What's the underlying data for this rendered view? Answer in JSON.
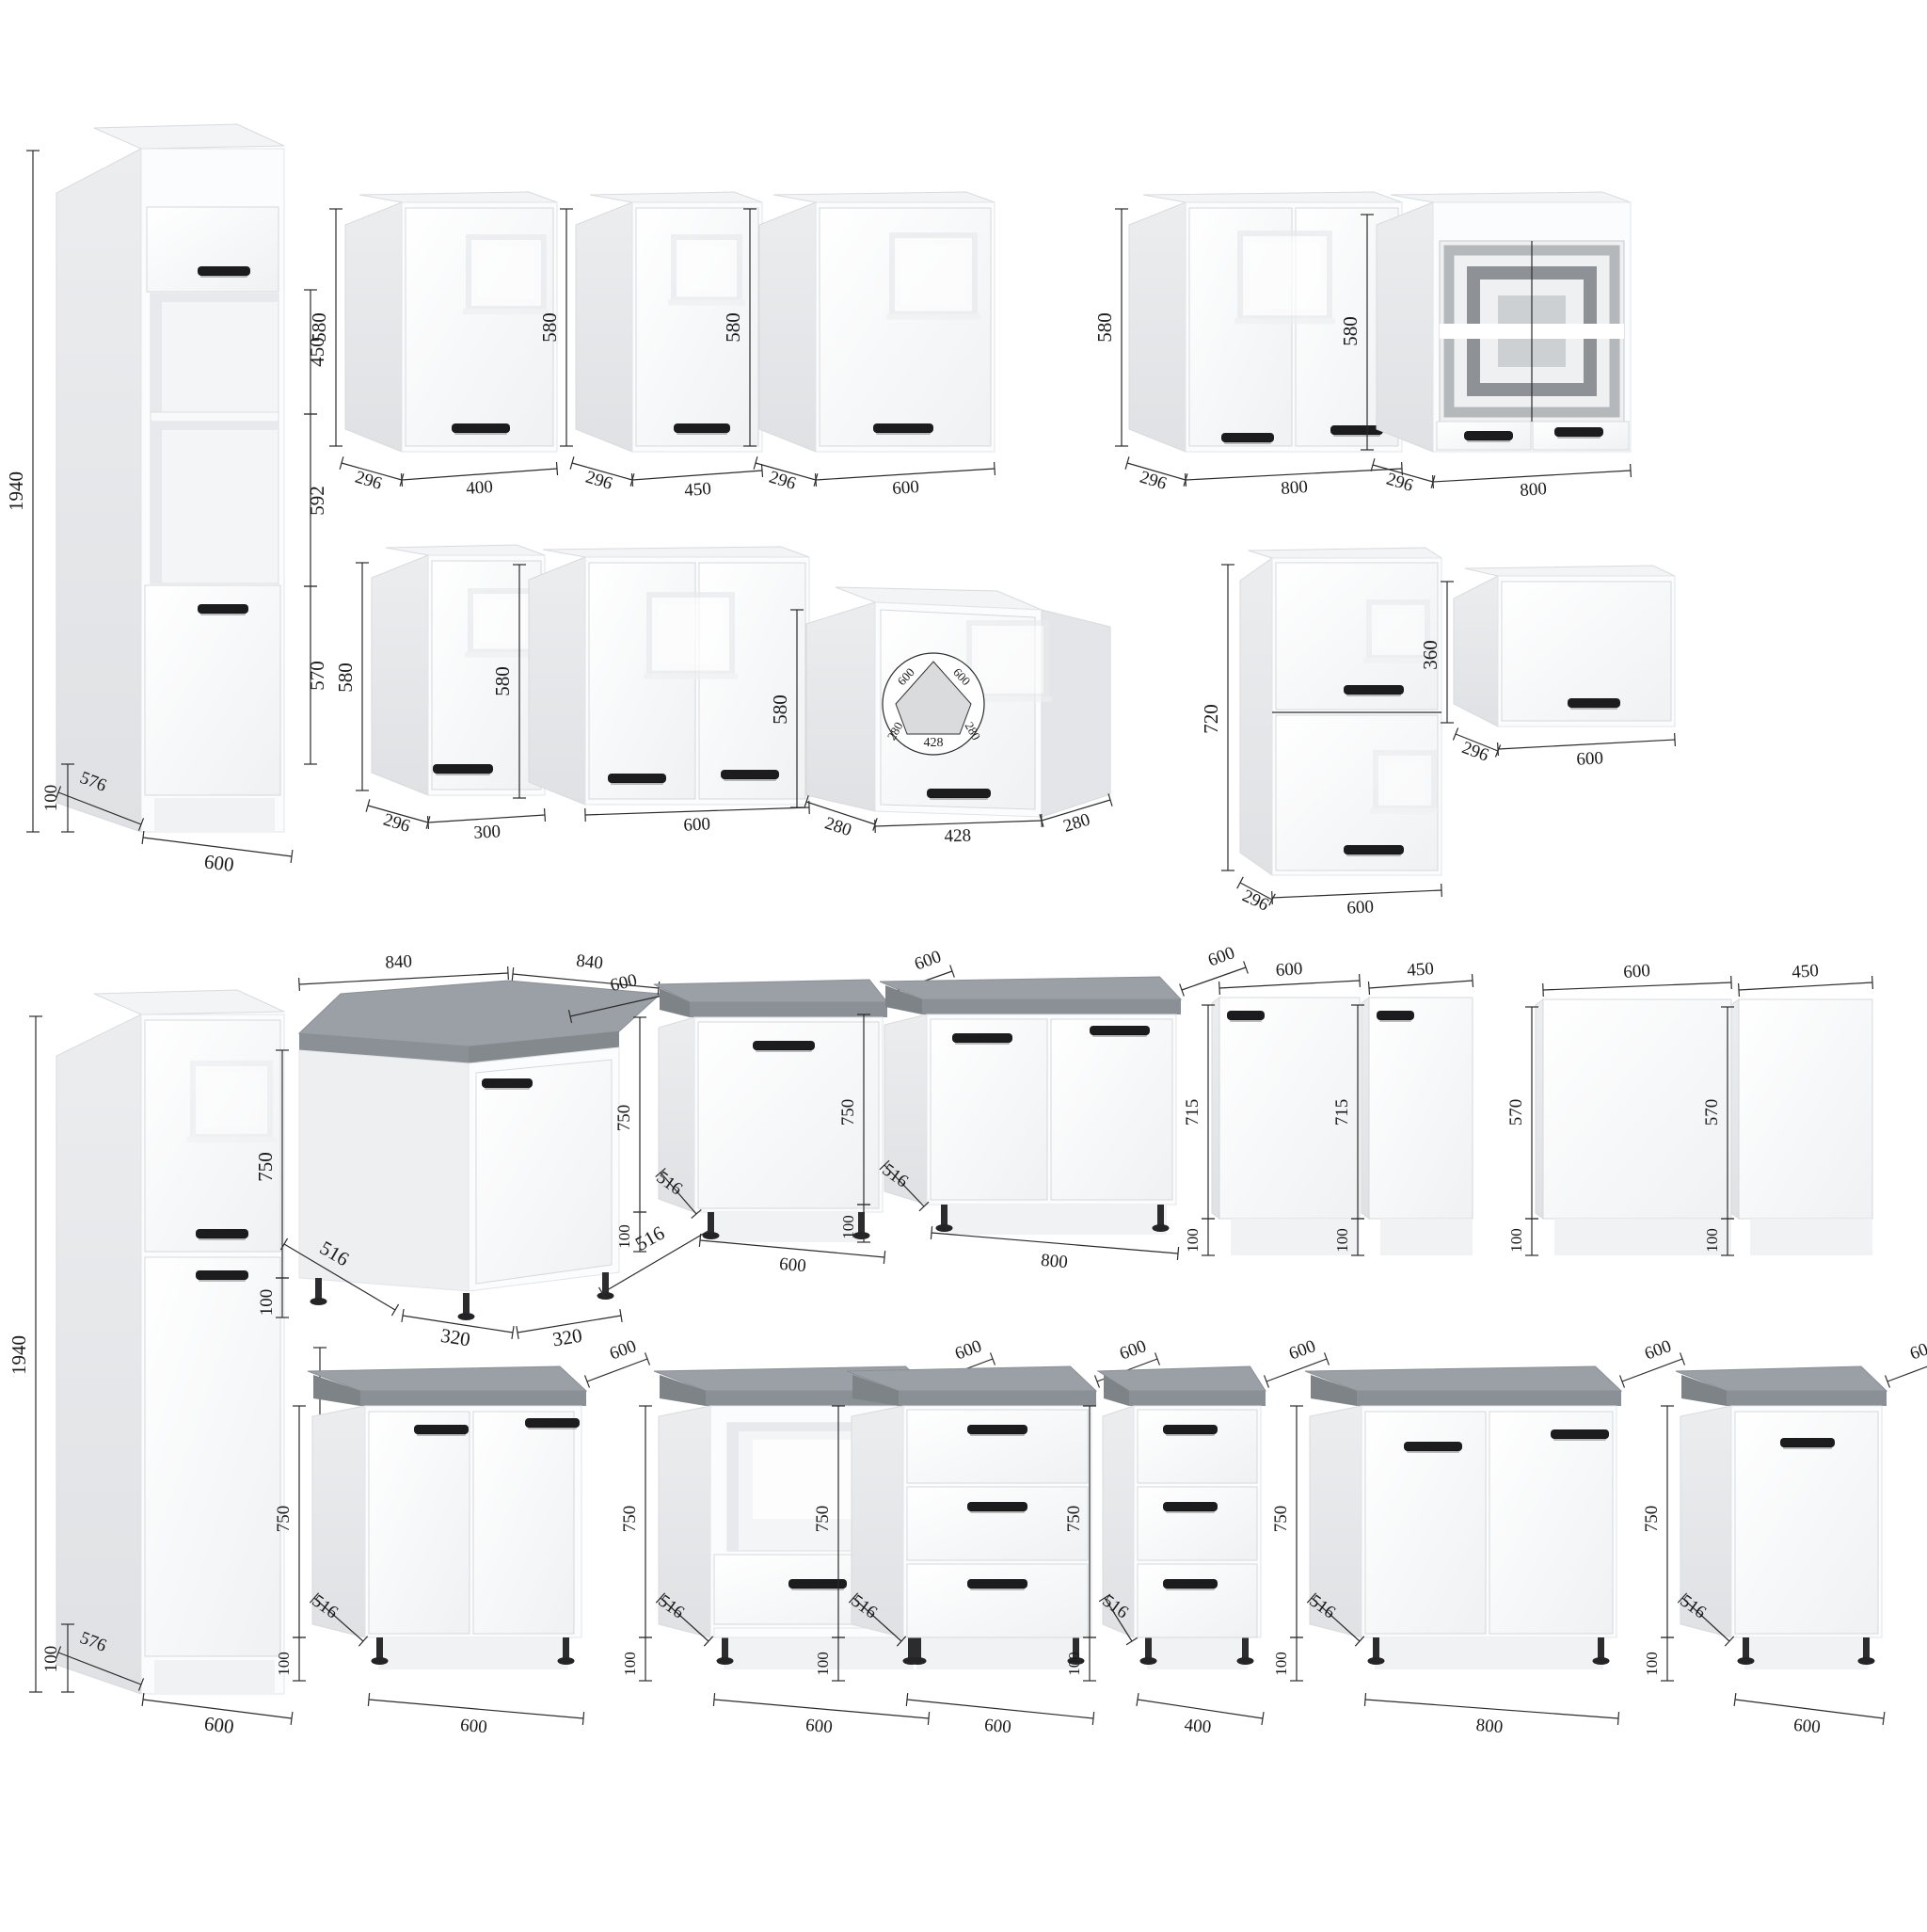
{
  "page": {
    "background": "#ffffff",
    "kind": "kitchen-cabinet-dimension-diagram"
  },
  "colors": {
    "front": "#fbfcfd",
    "side": "#e8eaec",
    "countertop_top": "#9aa0a5",
    "countertop_front": "#8a9095",
    "handle": "#1c1c1e",
    "dimension_line": "#2b2b2b",
    "label_text": "#1a1a1a",
    "glass_frame_silver": "#b5b8bb",
    "glass_frame_grey": "#8e9296"
  },
  "cabinets": {
    "tall_oven": {
      "title": "tall-oven-housing-cabinet",
      "total": "1940",
      "upper": "450",
      "middle": "592",
      "lower": "570",
      "plinth": "100",
      "depth": "576",
      "width": "600"
    },
    "wall_400": {
      "title": "wall-cabinet-400",
      "height": "580",
      "depth": "296",
      "width": "400"
    },
    "wall_450": {
      "title": "wall-cabinet-450",
      "height": "580",
      "depth": "296",
      "width": "450"
    },
    "wall_600": {
      "title": "wall-cabinet-600",
      "height": "580",
      "depth": "296",
      "width": "600"
    },
    "wall_800": {
      "title": "wall-cabinet-800-two-door",
      "height": "580",
      "depth": "296",
      "width": "800"
    },
    "wall_800_glass": {
      "title": "wall-cabinet-800-glass",
      "height": "580",
      "depth": "296",
      "width": "800"
    },
    "wall_300": {
      "title": "wall-cabinet-300",
      "height": "580",
      "depth": "296",
      "width": "300"
    },
    "wall_600_double": {
      "title": "wall-cabinet-600-two-door",
      "height": "580",
      "width": "600"
    },
    "wall_corner": {
      "title": "corner-wall-cabinet",
      "height": "580",
      "left": "280",
      "front": "428",
      "right": "280",
      "plan_a": "600",
      "plan_b": "600",
      "plan_left": "280",
      "plan_front": "428",
      "plan_right": "280"
    },
    "wall_600_h720": {
      "title": "wall-cabinet-600x720",
      "height": "720",
      "depth": "296",
      "width": "600"
    },
    "wall_600_h360": {
      "title": "wall-cabinet-600x360",
      "height": "360",
      "depth": "296",
      "width": "600"
    },
    "tall_fridge": {
      "title": "tall-fridge-housing-cabinet",
      "total": "1940",
      "lower": "720",
      "plinth": "100",
      "depth": "576",
      "width": "600"
    },
    "base_corner": {
      "title": "corner-base-cabinet",
      "top_left": "840",
      "top_right": "840",
      "top_depth": "600",
      "height": "750",
      "plinth": "100",
      "b1": "516",
      "b2": "320",
      "b3": "320",
      "b4": "516"
    },
    "base_600": {
      "title": "base-cabinet-600",
      "top": "600",
      "height": "750",
      "plinth": "100",
      "depth": "516",
      "width": "600"
    },
    "base_800": {
      "title": "base-cabinet-800-two-door",
      "top": "600",
      "height": "750",
      "plinth": "100",
      "depth": "516",
      "width": "800"
    },
    "front_600_715": {
      "title": "appliance-front-600x715",
      "width": "600",
      "height": "715",
      "plinth": "100"
    },
    "front_450_715": {
      "title": "appliance-front-450x715",
      "width": "450",
      "height": "715",
      "plinth": "100"
    },
    "front_600_570": {
      "title": "appliance-front-600x570",
      "width": "600",
      "height": "570",
      "plinth": "100"
    },
    "front_450_570": {
      "title": "appliance-front-450x570",
      "width": "450",
      "height": "570",
      "plinth": "100"
    },
    "base_600_double": {
      "title": "base-cabinet-600-two-door",
      "top": "600",
      "height": "750",
      "plinth": "100",
      "depth": "516",
      "width": "600"
    },
    "base_600_oven": {
      "title": "oven-base-cabinet-600",
      "top": "600",
      "height": "750",
      "plinth": "100",
      "depth": "516",
      "width": "600"
    },
    "base_600_drawers": {
      "title": "drawer-base-cabinet-600",
      "top": "600",
      "height": "750",
      "plinth": "100",
      "depth": "516",
      "width": "600"
    },
    "base_400_drawers": {
      "title": "drawer-base-cabinet-400",
      "top": "600",
      "height": "750",
      "plinth": "100",
      "depth": "516",
      "width": "400"
    },
    "base_800_r4": {
      "title": "base-cabinet-800-two-door",
      "top": "600",
      "height": "750",
      "plinth": "100",
      "depth": "516",
      "width": "800"
    },
    "base_600_door": {
      "title": "base-cabinet-600-single-door",
      "top": "600",
      "height": "750",
      "plinth": "100",
      "depth": "516",
      "width": "600"
    }
  }
}
